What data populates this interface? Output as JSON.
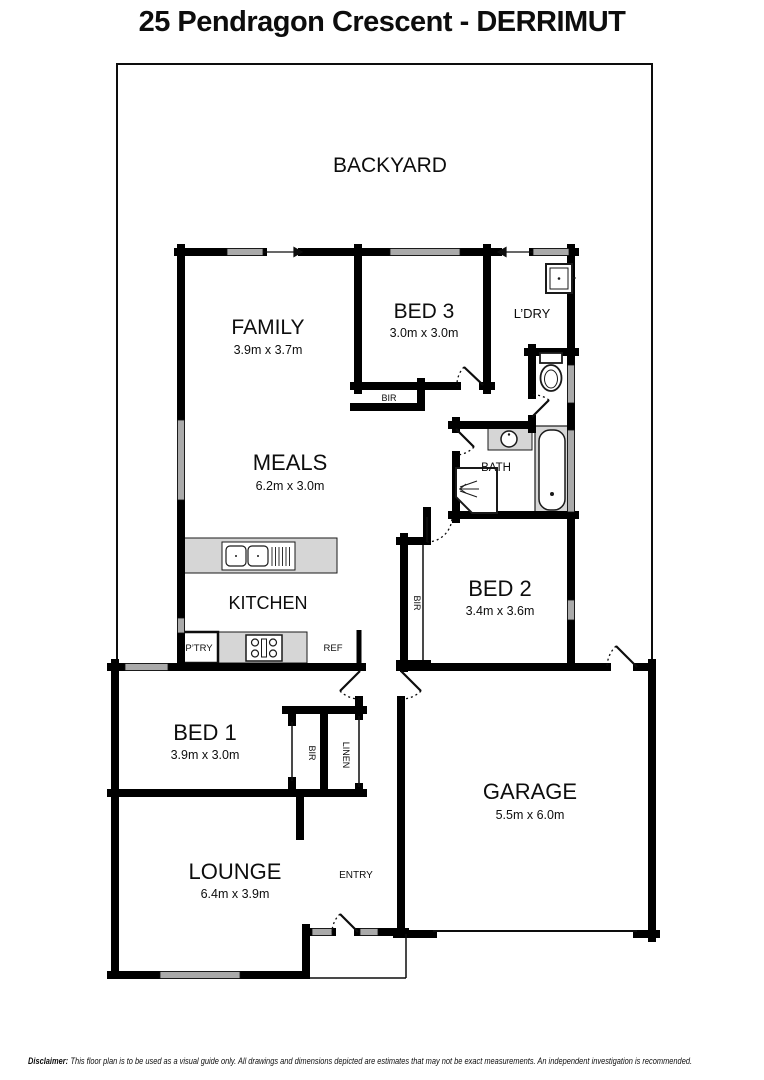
{
  "title": "25 Pendragon Crescent - DERRIMUT",
  "areas": {
    "backyard": {
      "label": "BACKYARD"
    },
    "family": {
      "label": "FAMILY",
      "dims": "3.9m x 3.7m"
    },
    "bed3": {
      "label": "BED 3",
      "dims": "3.0m x 3.0m"
    },
    "laundry": {
      "label": "L’DRY"
    },
    "meals": {
      "label": "MEALS",
      "dims": "6.2m x 3.0m"
    },
    "bath": {
      "label": "BATH"
    },
    "bed2": {
      "label": "BED 2",
      "dims": "3.4m x 3.6m"
    },
    "kitchen": {
      "label": "KITCHEN"
    },
    "pantry": {
      "label": "P’TRY"
    },
    "fridge": {
      "label": "REF"
    },
    "bir_bed3": {
      "label": "BIR"
    },
    "bir_bed2": {
      "label": "BIR"
    },
    "bed1": {
      "label": "BED 1",
      "dims": "3.9m x 3.0m"
    },
    "bir_bed1": {
      "label": "BIR"
    },
    "linen": {
      "label": "LINEN"
    },
    "garage": {
      "label": "GARAGE",
      "dims": "5.5m x 6.0m"
    },
    "lounge": {
      "label": "LOUNGE",
      "dims": "6.4m x 3.9m"
    },
    "entry": {
      "label": "ENTRY"
    }
  },
  "disclaimer": {
    "prefix": "Disclaimer:",
    "text": "This floor plan is to be used as a visual guide only. All drawings and dimensions depicted are estimates that may not be exact measurements. An independent investigation is recommended."
  },
  "colors": {
    "wall": "#000000",
    "window": "#aaaaaa",
    "bench": "#d6d6d6",
    "background": "#ffffff"
  }
}
